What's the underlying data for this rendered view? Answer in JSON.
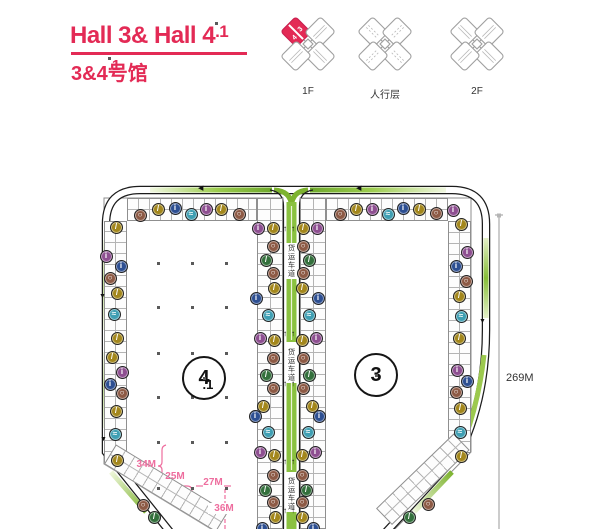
{
  "colors": {
    "pink": "#e32a55",
    "dim_pink": "#ee6d9e",
    "road_green": "#8bc53f"
  },
  "header": {
    "title_main": "Hall 3& Hall 4",
    "title_dot": ".1",
    "sub_main": "3&4",
    "sub_dot": ".1",
    "sub_tail": "号馆"
  },
  "floors": [
    {
      "label": "1F",
      "highlight": true,
      "badges": [
        "3",
        "4"
      ]
    },
    {
      "label": "人行层",
      "highlight": false,
      "dashed": true,
      "badges": []
    },
    {
      "label": "2F",
      "highlight": false,
      "badges": []
    }
  ],
  "plan": {
    "hall_left": {
      "num": "4",
      "dot": ".1"
    },
    "hall_right": {
      "num": "3",
      "dot": ""
    },
    "lane_text": "货运车道",
    "lane_blocks": [
      243,
      347,
      476
    ],
    "lane_arrow_glyph": "↑",
    "lane_arrows": [
      225,
      330,
      380,
      458,
      507
    ],
    "road_arrows": [
      {
        "x": 198,
        "y": 185,
        "g": "◀"
      },
      {
        "x": 356,
        "y": 185,
        "g": "◀"
      },
      {
        "x": 99,
        "y": 293,
        "g": "▼"
      },
      {
        "x": 100,
        "y": 436,
        "g": "▼"
      },
      {
        "x": 479,
        "y": 318,
        "g": "▼"
      }
    ],
    "dims": {
      "d34": "34M",
      "d25": "25M",
      "d27": "27M",
      "d36": "36M",
      "d269": "269M"
    },
    "columns_grid": {
      "cols": [
        158,
        192,
        226
      ],
      "rows": [
        263,
        307,
        353,
        397,
        442,
        488
      ]
    },
    "icon_types": {
      "o": {
        "name": "escalator-icon",
        "color": "#a3871c",
        "glyph": "/"
      },
      "g": {
        "name": "stairs-icon",
        "color": "#33703c",
        "glyph": "/"
      },
      "b": {
        "name": "restaurant-icon",
        "color": "#8d5a45",
        "glyph": "○"
      },
      "u": {
        "name": "info-icon",
        "color": "#2d4f92",
        "glyph": "i"
      },
      "p": {
        "name": "restroom-icon",
        "color": "#8e4f91",
        "glyph": "i"
      },
      "t": {
        "name": "water-icon",
        "color": "#3f9fb3",
        "glyph": "≈"
      }
    },
    "icons": [
      [
        140,
        215,
        "b"
      ],
      [
        158,
        209,
        "o"
      ],
      [
        175,
        208,
        "u"
      ],
      [
        191,
        214,
        "t"
      ],
      [
        206,
        209,
        "p"
      ],
      [
        221,
        209,
        "o"
      ],
      [
        239,
        214,
        "b"
      ],
      [
        340,
        214,
        "b"
      ],
      [
        356,
        209,
        "o"
      ],
      [
        372,
        209,
        "p"
      ],
      [
        388,
        214,
        "t"
      ],
      [
        403,
        208,
        "u"
      ],
      [
        419,
        209,
        "o"
      ],
      [
        436,
        213,
        "b"
      ],
      [
        453,
        210,
        "p"
      ],
      [
        116,
        227,
        "o"
      ],
      [
        106,
        256,
        "p"
      ],
      [
        121,
        266,
        "u"
      ],
      [
        110,
        278,
        "b"
      ],
      [
        117,
        293,
        "o"
      ],
      [
        114,
        314,
        "t"
      ],
      [
        117,
        338,
        "o"
      ],
      [
        112,
        357,
        "o"
      ],
      [
        122,
        372,
        "p"
      ],
      [
        110,
        384,
        "u"
      ],
      [
        122,
        393,
        "b"
      ],
      [
        116,
        411,
        "o"
      ],
      [
        115,
        434,
        "t"
      ],
      [
        117,
        460,
        "o"
      ],
      [
        143,
        505,
        "b"
      ],
      [
        154,
        517,
        "g"
      ],
      [
        461,
        224,
        "o"
      ],
      [
        467,
        252,
        "p"
      ],
      [
        456,
        266,
        "u"
      ],
      [
        466,
        281,
        "b"
      ],
      [
        459,
        296,
        "o"
      ],
      [
        461,
        316,
        "t"
      ],
      [
        459,
        338,
        "o"
      ],
      [
        457,
        370,
        "p"
      ],
      [
        467,
        381,
        "u"
      ],
      [
        456,
        392,
        "b"
      ],
      [
        460,
        408,
        "o"
      ],
      [
        460,
        432,
        "t"
      ],
      [
        461,
        456,
        "o"
      ],
      [
        428,
        504,
        "b"
      ],
      [
        409,
        517,
        "g"
      ],
      [
        273,
        228,
        "o"
      ],
      [
        258,
        228,
        "p"
      ],
      [
        273,
        246,
        "b"
      ],
      [
        266,
        260,
        "g"
      ],
      [
        273,
        273,
        "b"
      ],
      [
        274,
        288,
        "o"
      ],
      [
        256,
        298,
        "u"
      ],
      [
        268,
        315,
        "t"
      ],
      [
        260,
        338,
        "p"
      ],
      [
        274,
        340,
        "o"
      ],
      [
        273,
        358,
        "b"
      ],
      [
        266,
        375,
        "g"
      ],
      [
        273,
        388,
        "b"
      ],
      [
        263,
        406,
        "o"
      ],
      [
        255,
        416,
        "u"
      ],
      [
        268,
        432,
        "t"
      ],
      [
        260,
        452,
        "p"
      ],
      [
        274,
        455,
        "o"
      ],
      [
        273,
        475,
        "b"
      ],
      [
        265,
        490,
        "g"
      ],
      [
        273,
        502,
        "b"
      ],
      [
        275,
        517,
        "o"
      ],
      [
        262,
        528,
        "u"
      ],
      [
        303,
        228,
        "o"
      ],
      [
        317,
        228,
        "p"
      ],
      [
        303,
        246,
        "b"
      ],
      [
        309,
        260,
        "g"
      ],
      [
        303,
        273,
        "b"
      ],
      [
        302,
        288,
        "o"
      ],
      [
        318,
        298,
        "u"
      ],
      [
        309,
        315,
        "t"
      ],
      [
        316,
        338,
        "p"
      ],
      [
        302,
        340,
        "o"
      ],
      [
        303,
        358,
        "b"
      ],
      [
        309,
        375,
        "g"
      ],
      [
        303,
        388,
        "b"
      ],
      [
        312,
        406,
        "o"
      ],
      [
        319,
        416,
        "u"
      ],
      [
        308,
        432,
        "t"
      ],
      [
        315,
        452,
        "p"
      ],
      [
        302,
        455,
        "o"
      ],
      [
        302,
        475,
        "b"
      ],
      [
        306,
        490,
        "g"
      ],
      [
        302,
        502,
        "b"
      ],
      [
        302,
        517,
        "o"
      ],
      [
        313,
        528,
        "u"
      ]
    ]
  }
}
